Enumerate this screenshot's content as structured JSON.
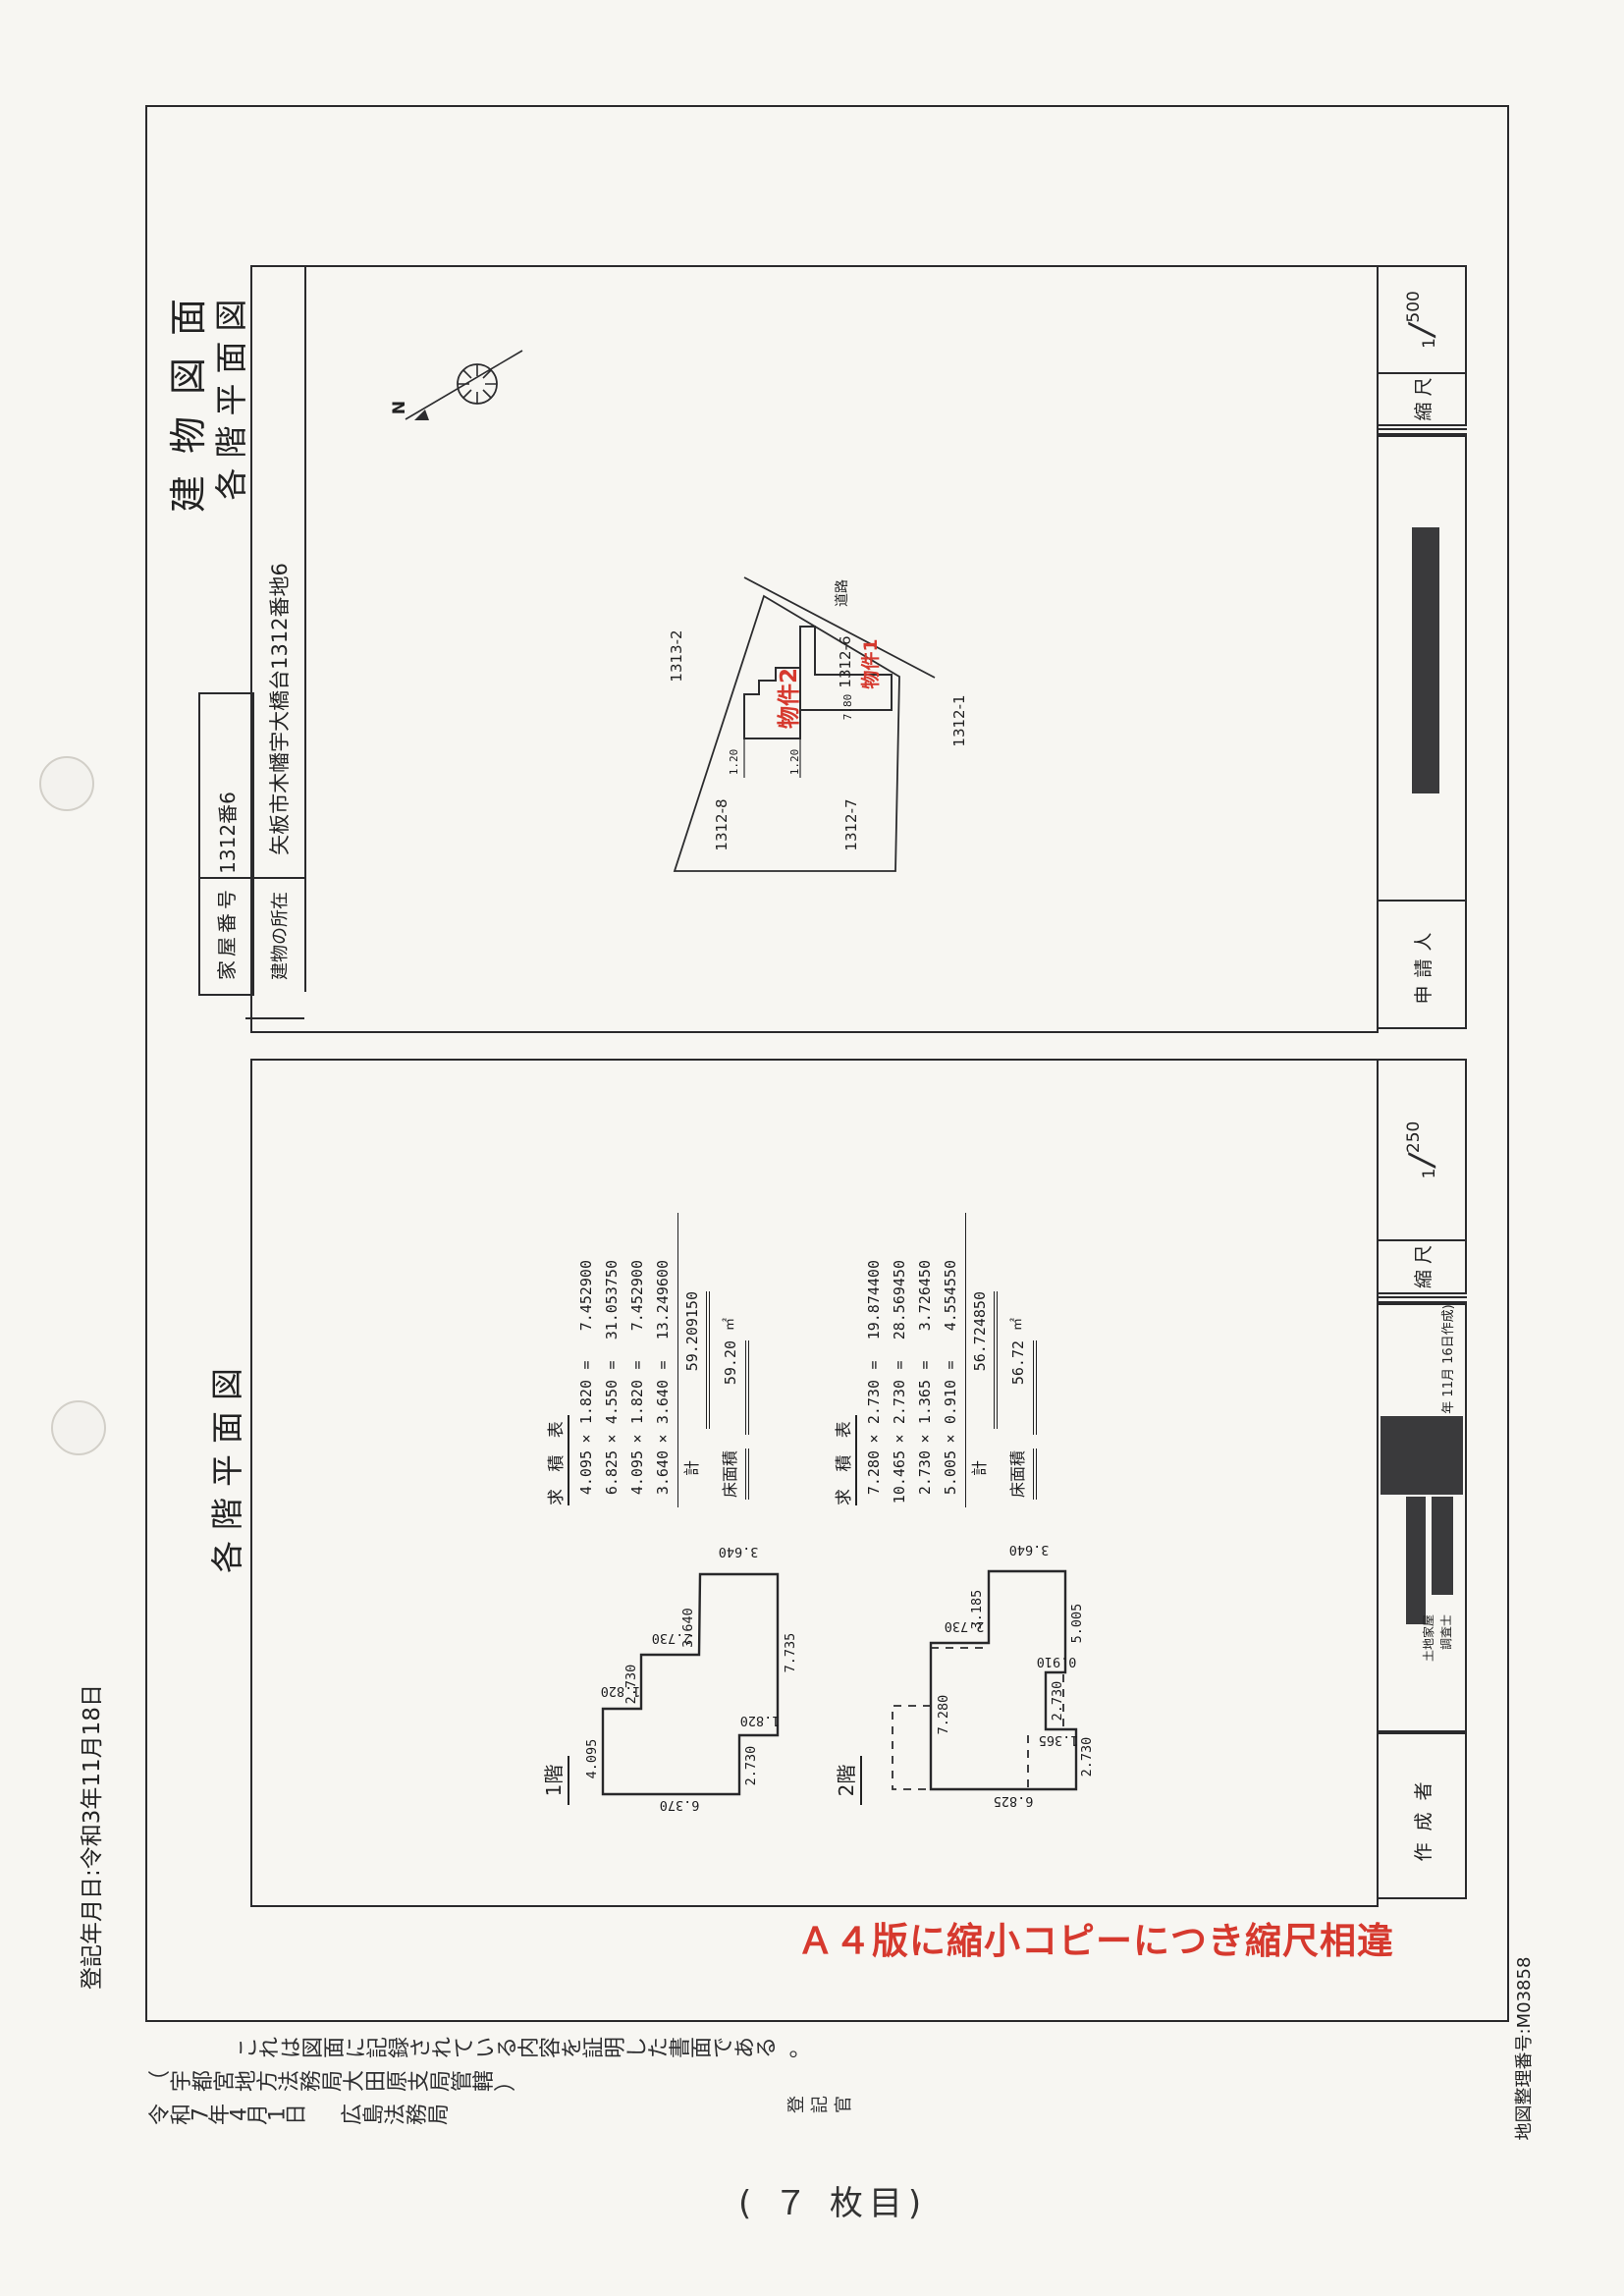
{
  "meta": {
    "registered_date_note": "登記年月日:令和3年11月18日",
    "sheet_page": "( ７ 枚目)",
    "map_ref": "地図整理番号:M03858",
    "registrar": "登記官",
    "red_stamp": "Ａ４版に縮小コピーにつき縮尺相違"
  },
  "titles": {
    "t1": "建物図面",
    "t2": "各階平面図",
    "floor_section": "各階平面図"
  },
  "property": {
    "house_label": "家屋番号",
    "house_value": "1312番6",
    "loc_label": "建物の所在",
    "loc_value": "矢板市木幡宇大橋台1312番地6"
  },
  "site_plan": {
    "road": "道路",
    "lots": [
      "1313-2",
      "1312-8",
      "1312-7",
      "1312-6",
      "1312-1"
    ],
    "bldg1": "物件1",
    "bldg2": "物件2",
    "dims": [
      "1.20",
      "1.20",
      "7.80"
    ],
    "north": "N"
  },
  "floors": {
    "f1": {
      "label": "1階",
      "dims": [
        "3.640",
        "7.735",
        "1.820",
        "2.730",
        "6.370",
        "4.095",
        "1.820",
        "2.730",
        "2.730",
        "3.640"
      ]
    },
    "f2": {
      "label": "2階",
      "dims": [
        "3.640",
        "3.185",
        "2.730",
        "7.280",
        "5.005",
        "0.910",
        "2.730",
        "1.365",
        "2.730",
        "6.825"
      ]
    }
  },
  "tables": {
    "sym_mul": "×",
    "sym_eq": "=",
    "f1": {
      "title": "求 積 表",
      "rows": [
        {
          "a": "4.095",
          "b": "1.820",
          "r": "7.452900"
        },
        {
          "a": "6.825",
          "b": "4.550",
          "r": "31.053750"
        },
        {
          "a": "4.095",
          "b": "1.820",
          "r": "7.452900"
        },
        {
          "a": "3.640",
          "b": "3.640",
          "r": "13.249600"
        }
      ],
      "total_label": "計",
      "total": "59.209150",
      "area_label": "床面積",
      "area": "59.20",
      "unit": "㎡"
    },
    "f2": {
      "title": "求 積 表",
      "rows": [
        {
          "a": "7.280",
          "b": "2.730",
          "r": "19.874400"
        },
        {
          "a": "10.465",
          "b": "2.730",
          "r": "28.569450"
        },
        {
          "a": "2.730",
          "b": "1.365",
          "r": "3.726450"
        },
        {
          "a": "5.005",
          "b": "0.910",
          "r": "4.554550"
        }
      ],
      "total_label": "計",
      "total": "56.724850",
      "area_label": "床面積",
      "area": "56.72",
      "unit": "㎡"
    }
  },
  "info": {
    "scale_label": "縮 尺",
    "scale1": {
      "num": "1",
      "den": "500"
    },
    "scale2": {
      "num": "1",
      "den": "250"
    },
    "frac_slash": "∕",
    "applicant": "申請人",
    "creator": "作成者",
    "date_note": "年 11月 16日作成)",
    "surveyor1": "土地家屋",
    "surveyor2": "調査士"
  },
  "cert": {
    "l1": "これは図面に記録されている内容を証明した書面である。",
    "l2": "（宇都宮地方法務局大田原支局管轄）",
    "l3": "令和7年4月1日",
    "l4": "広島法務局"
  }
}
